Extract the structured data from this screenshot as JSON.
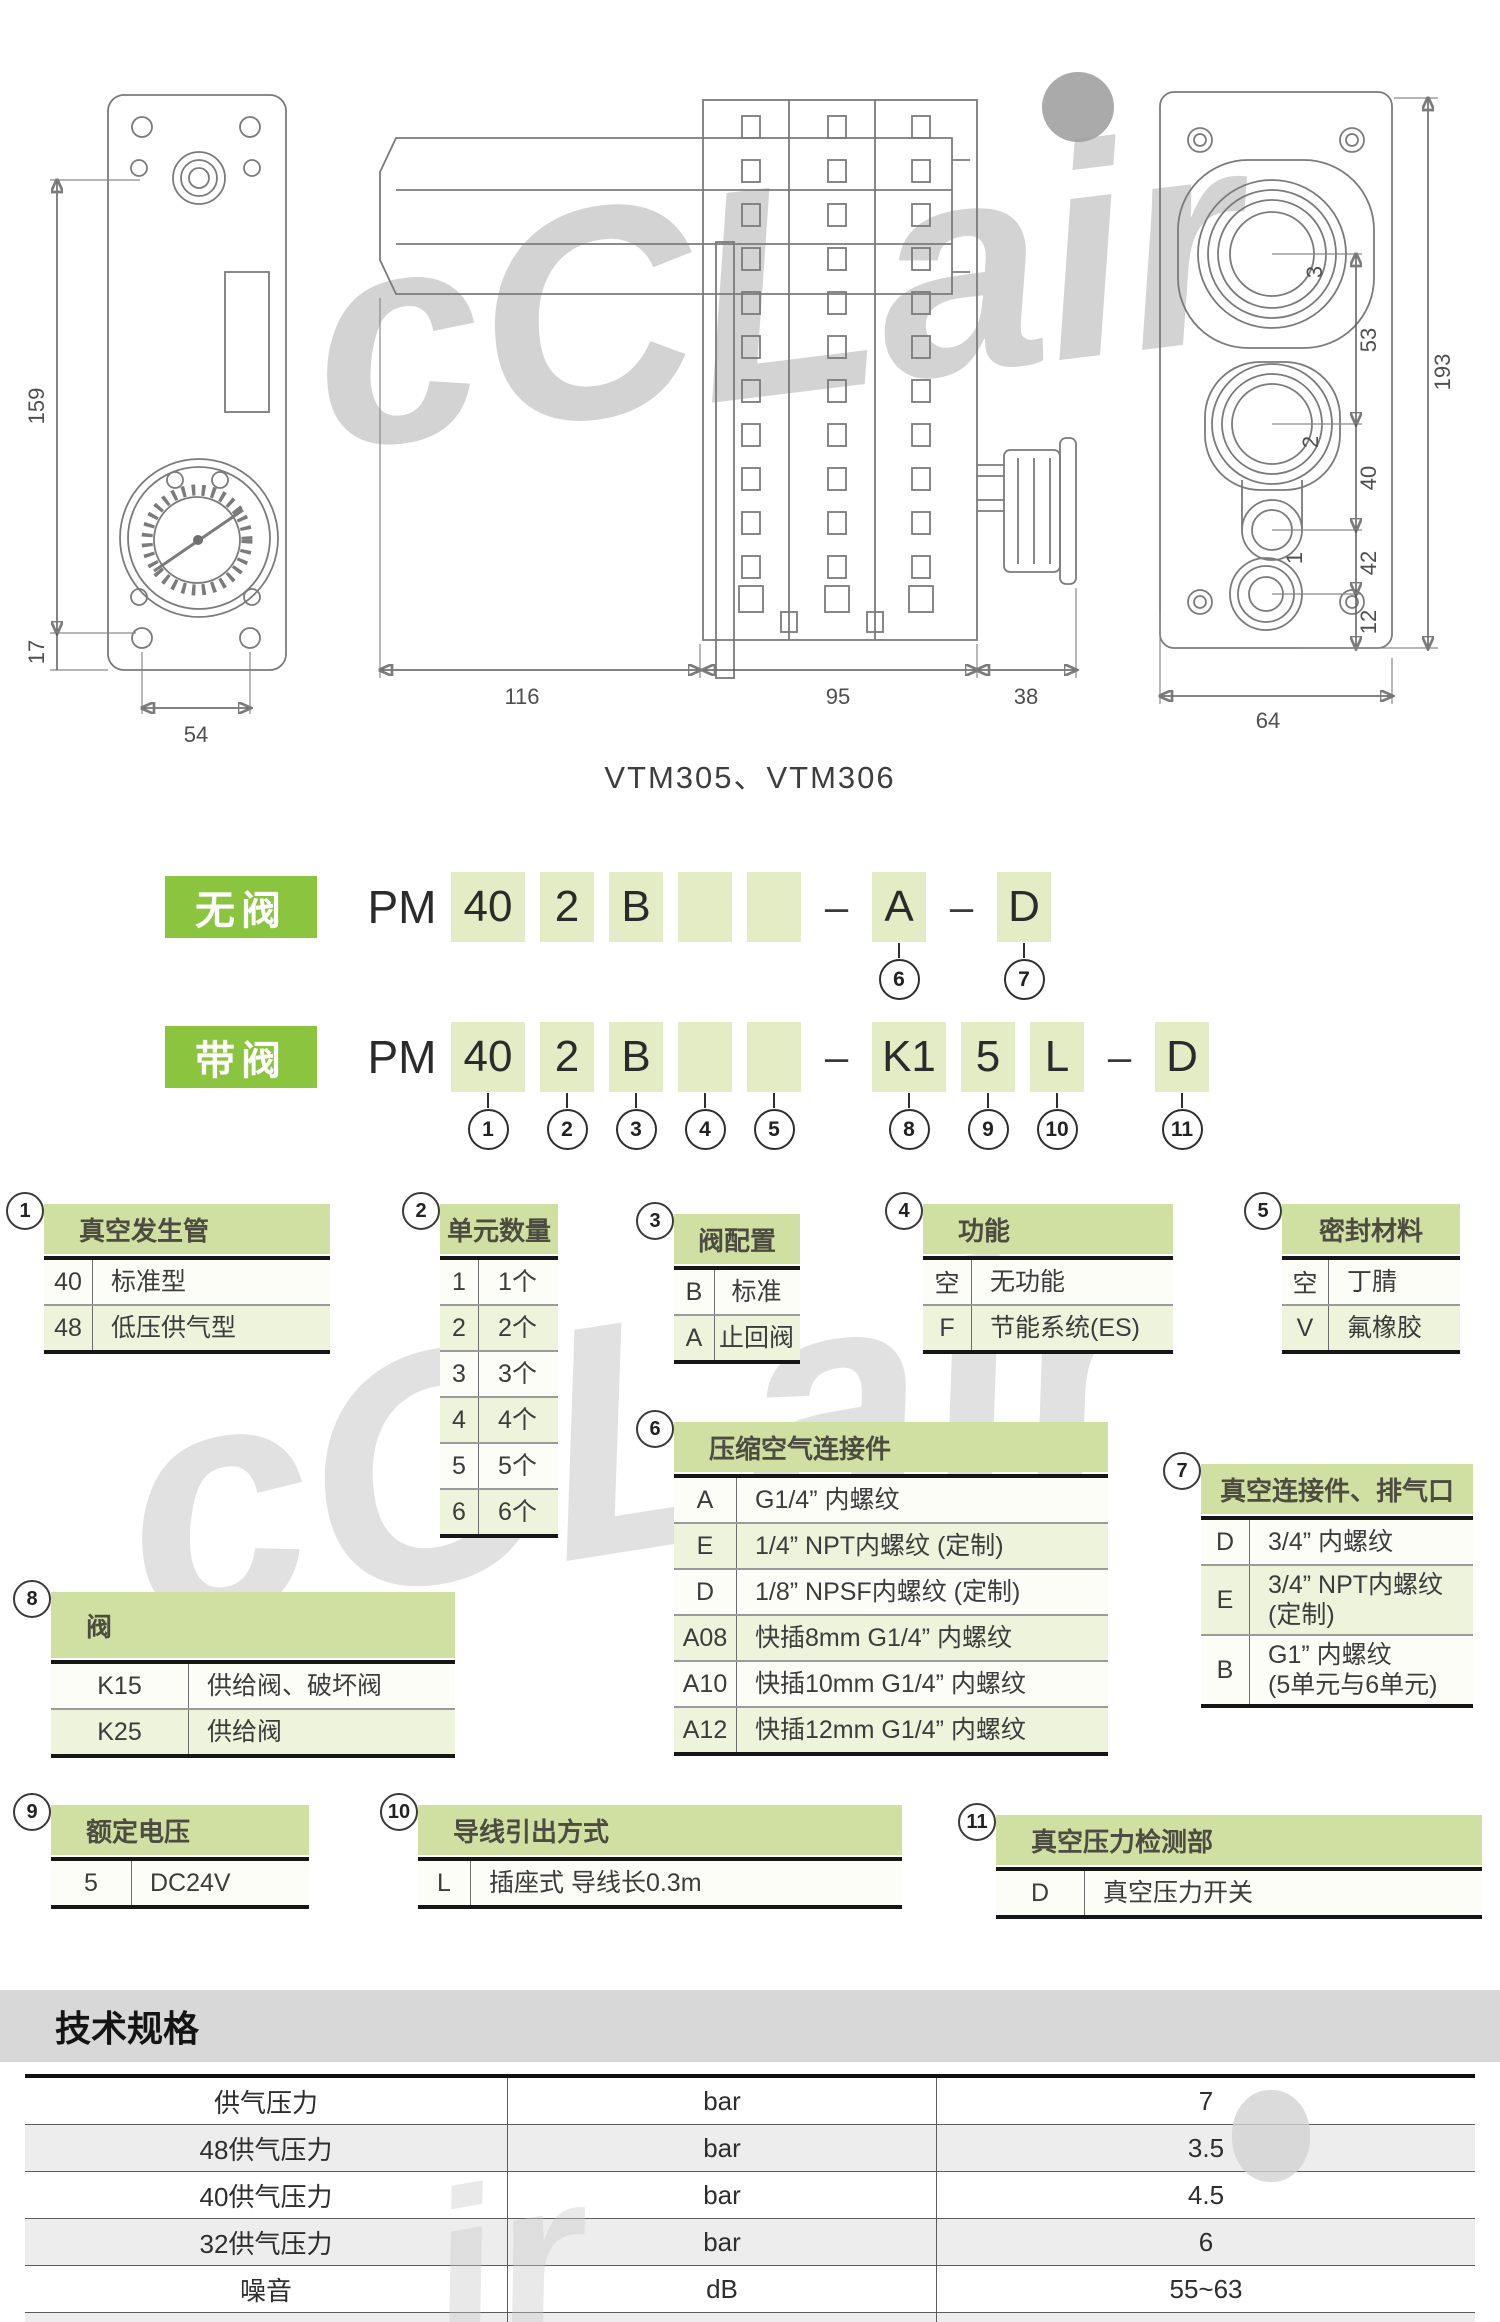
{
  "caption": "VTM305、VTM306",
  "drawings": {
    "dims": {
      "h159": "159",
      "h17": "17",
      "w54": "54",
      "w116": "116",
      "w95": "95",
      "w38": "38",
      "w64": "64",
      "h193": "193",
      "h53": "53",
      "h40": "40",
      "h42": "42",
      "h12": "12"
    },
    "ports": {
      "p3": "3",
      "p2": "2",
      "p1": "1"
    }
  },
  "code_rows": [
    {
      "tag": "无阀",
      "prefix": "PM",
      "cells": [
        {
          "text": "40",
          "box": true
        },
        {
          "text": "2",
          "box": true
        },
        {
          "text": "B",
          "box": true
        },
        {
          "text": "",
          "box": true
        },
        {
          "text": "",
          "box": true
        },
        {
          "text": "–",
          "box": false
        },
        {
          "text": "A",
          "box": true,
          "circle": "6"
        },
        {
          "text": "–",
          "box": false
        },
        {
          "text": "D",
          "box": true,
          "circle": "7"
        }
      ]
    },
    {
      "tag": "带阀",
      "prefix": "PM",
      "cells": [
        {
          "text": "40",
          "box": true,
          "circle": "1"
        },
        {
          "text": "2",
          "box": true,
          "circle": "2"
        },
        {
          "text": "B",
          "box": true,
          "circle": "3"
        },
        {
          "text": "",
          "box": true,
          "circle": "4"
        },
        {
          "text": "",
          "box": true,
          "circle": "5"
        },
        {
          "text": "–",
          "box": false
        },
        {
          "text": "K1",
          "box": true,
          "circle": "8"
        },
        {
          "text": "5",
          "box": true,
          "circle": "9"
        },
        {
          "text": "L",
          "box": true,
          "circle": "10"
        },
        {
          "text": "–",
          "box": false
        },
        {
          "text": "D",
          "box": true,
          "circle": "11"
        }
      ]
    }
  ],
  "option_tables": [
    {
      "num": "1",
      "title": "真空发生管",
      "rows": [
        [
          "40",
          "标准型"
        ],
        [
          "48",
          "低压供气型"
        ]
      ]
    },
    {
      "num": "2",
      "title": "单元数量",
      "rows": [
        [
          "1",
          "1个"
        ],
        [
          "2",
          "2个"
        ],
        [
          "3",
          "3个"
        ],
        [
          "4",
          "4个"
        ],
        [
          "5",
          "5个"
        ],
        [
          "6",
          "6个"
        ]
      ]
    },
    {
      "num": "3",
      "title": "阀配置",
      "rows": [
        [
          "B",
          "标准"
        ],
        [
          "A",
          "止回阀"
        ]
      ]
    },
    {
      "num": "4",
      "title": "功能",
      "rows": [
        [
          "空",
          "无功能"
        ],
        [
          "F",
          "节能系统(ES)"
        ]
      ]
    },
    {
      "num": "5",
      "title": "密封材料",
      "rows": [
        [
          "空",
          "丁腈"
        ],
        [
          "V",
          "氟橡胶"
        ]
      ]
    },
    {
      "num": "6",
      "title": "压缩空气连接件",
      "rows": [
        [
          "A",
          "G1/4” 内螺纹"
        ],
        [
          "E",
          "1/4” NPT内螺纹 (定制)"
        ],
        [
          "D",
          "1/8” NPSF内螺纹 (定制)"
        ],
        [
          "A08",
          "快插8mm G1/4” 内螺纹"
        ],
        [
          "A10",
          "快插10mm G1/4” 内螺纹"
        ],
        [
          "A12",
          "快插12mm G1/4” 内螺纹"
        ]
      ]
    },
    {
      "num": "7",
      "title": "真空连接件、排气口",
      "rows": [
        [
          "D",
          "3/4” 内螺纹"
        ],
        [
          "E",
          "3/4” NPT内螺纹\n(定制)"
        ],
        [
          "B",
          "G1” 内螺纹\n(5单元与6单元)"
        ]
      ]
    },
    {
      "num": "8",
      "title": "阀",
      "rows": [
        [
          "K15",
          "供给阀、破坏阀"
        ],
        [
          "K25",
          "供给阀"
        ]
      ]
    },
    {
      "num": "9",
      "title": "额定电压",
      "rows": [
        [
          "5",
          "DC24V"
        ]
      ]
    },
    {
      "num": "10",
      "title": "导线引出方式",
      "rows": [
        [
          "L",
          "插座式 导线长0.3m"
        ]
      ]
    },
    {
      "num": "11",
      "title": "真空压力检测部",
      "rows": [
        [
          "D",
          "真空压力开关"
        ]
      ]
    }
  ],
  "spec": {
    "title": "技术规格",
    "rows": [
      [
        "供气压力",
        "bar",
        "7"
      ],
      [
        "48供气压力",
        "bar",
        "3.5"
      ],
      [
        "40供气压力",
        "bar",
        "4.5"
      ],
      [
        "32供气压力",
        "bar",
        "6"
      ],
      [
        "噪音",
        "dB",
        "55~63"
      ],
      [
        "温度范围",
        "℃",
        "-20~80"
      ]
    ]
  },
  "watermark": {
    "main": "cCLair",
    "mid": "cCLair",
    "bottom": "ir"
  }
}
